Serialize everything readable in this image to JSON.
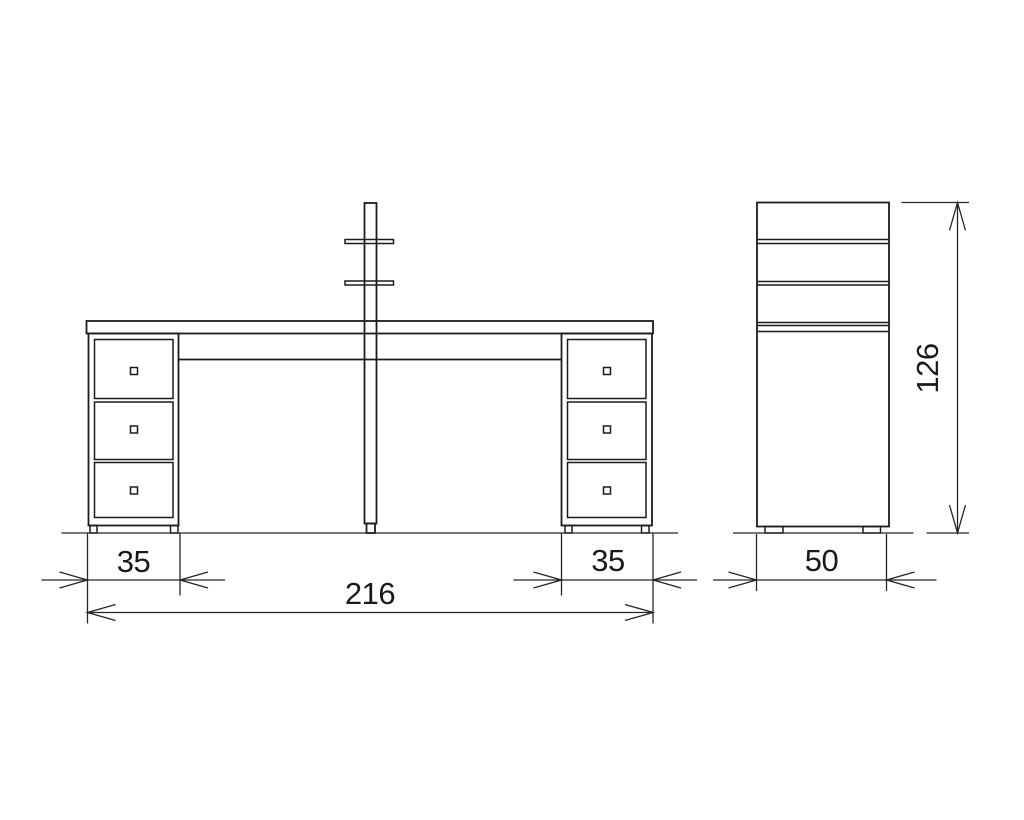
{
  "diagram": {
    "type": "furniture-orthographic-drawing",
    "subject": "desk with two drawer pedestals and shelf pole",
    "background": "#ffffff",
    "line_color": "#1c1c1c",
    "views": [
      {
        "id": "front",
        "dimensions": [
          {
            "name": "left-pedestal-width",
            "value": "35"
          },
          {
            "name": "overall-width",
            "value": "216"
          },
          {
            "name": "right-pedestal-width",
            "value": "35"
          }
        ]
      },
      {
        "id": "side",
        "dimensions": [
          {
            "name": "depth",
            "value": "50"
          },
          {
            "name": "overall-height",
            "value": "126"
          }
        ]
      }
    ]
  }
}
